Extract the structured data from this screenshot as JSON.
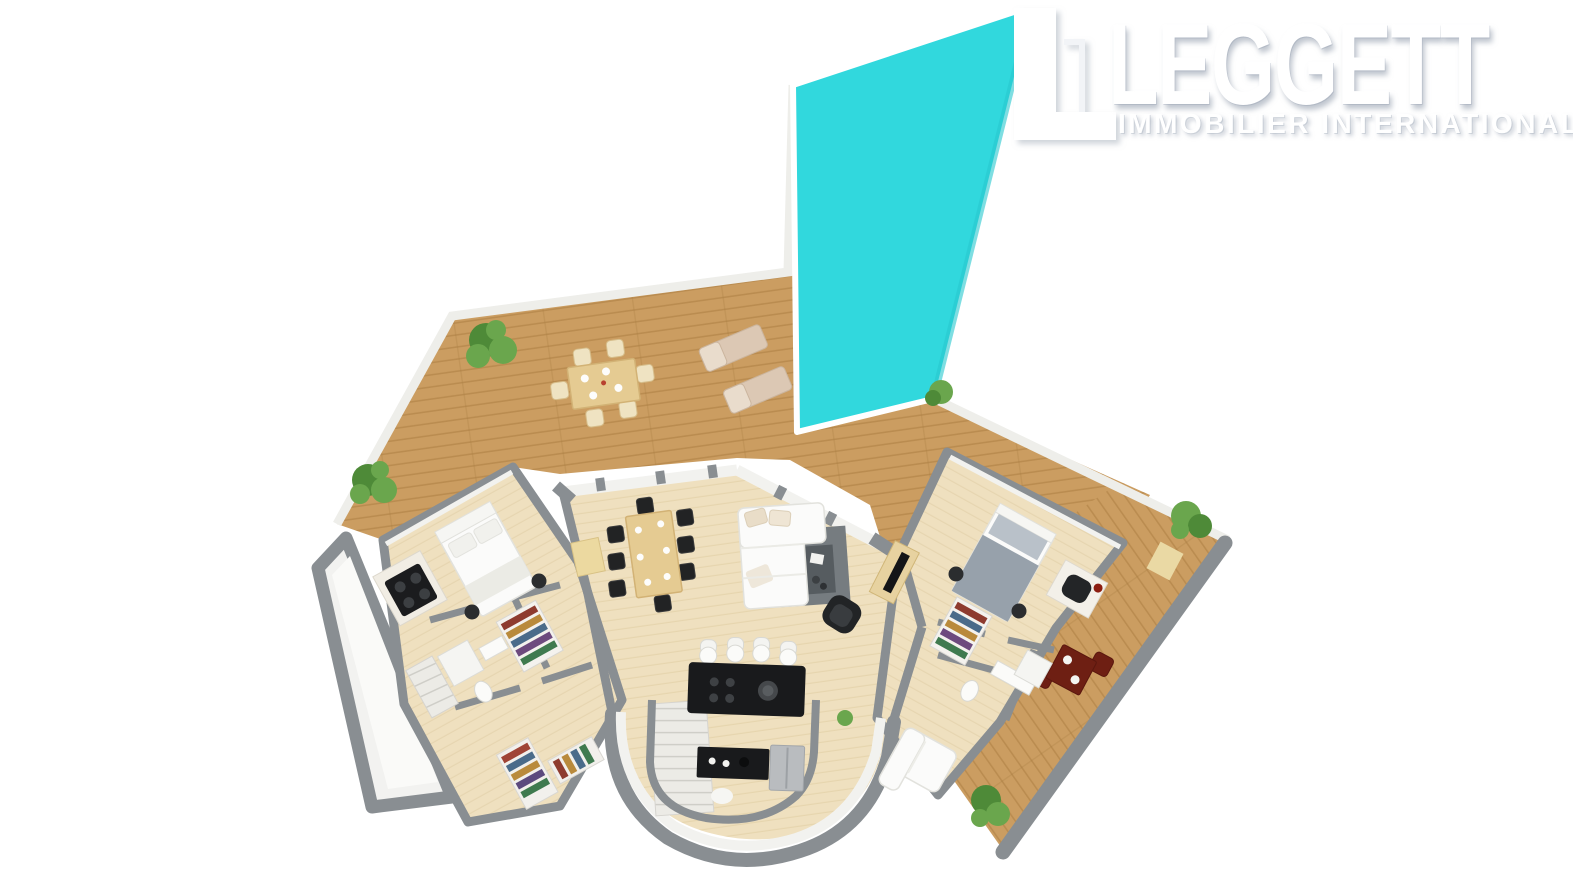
{
  "logo": {
    "brand": "LEGGETT",
    "tagline": "IMMOBILIER INTERNATIONAL"
  },
  "colors": {
    "pool": "#31d8dd",
    "deck": "#cb9d61",
    "deckline": "#ab7e42",
    "floor": "#efe0bf",
    "floorline": "#ddc99d",
    "wall": "#898e92",
    "wallband": "#f2f2ef",
    "wedge": "#f2f2f0",
    "rug": "#767c80",
    "rugtable": "#565c60",
    "island": "#191a1c",
    "woodfur": "#e5cb92",
    "cream": "#dcc8b4",
    "duvet": "#97a1ab",
    "silver": "#b9bcbf",
    "plant": "#6aa64d",
    "plantdark": "#4e8a38",
    "maroon": "#6e1f13",
    "white": "#fbfbfa"
  },
  "scene": {
    "type": "3d-floor-plan-render",
    "areas": [
      "swimming-pool",
      "sun-terrace",
      "living-dining-area",
      "open-kitchen",
      "curved-stairwell",
      "left-bedroom-suite",
      "right-bedroom-suite",
      "bathrooms",
      "walk-in-closet",
      "side-terrace",
      "balcony"
    ]
  }
}
